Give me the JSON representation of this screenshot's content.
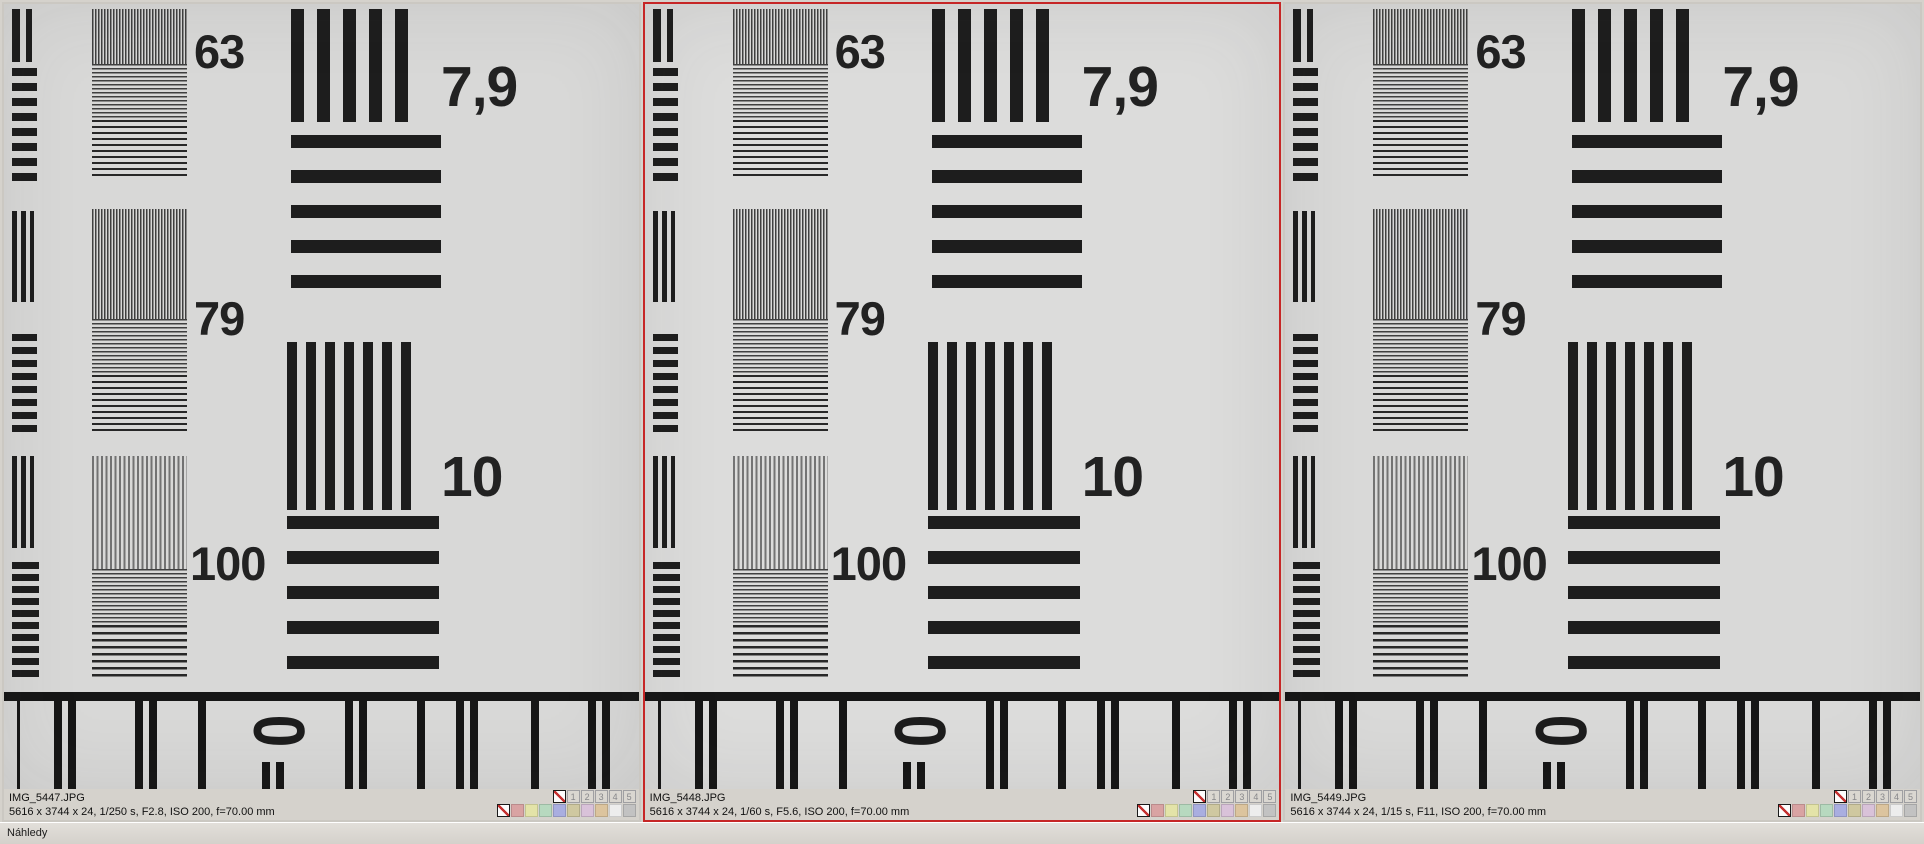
{
  "status_bar": {
    "text": "Náhledy"
  },
  "panels": [
    {
      "filename": "IMG_5447.JPG",
      "details": "5616 x 3744 x 24, 1/250 s, F2.8, ISO 200, f=70.00 mm",
      "selected": false
    },
    {
      "filename": "IMG_5448.JPG",
      "details": "5616 x 3744 x 24, 1/60 s, F5.6, ISO 200, f=70.00 mm",
      "selected": true
    },
    {
      "filename": "IMG_5449.JPG",
      "details": "5616 x 3744 x 24, 1/15 s, F11, ISO 200, f=70.00 mm",
      "selected": false
    }
  ],
  "rating": {
    "stars": [
      "1",
      "2",
      "3",
      "4",
      "5"
    ],
    "label_colors": [
      "#d9a3a3",
      "#e3e3a8",
      "#b7d9bf",
      "#a9aee0",
      "#cfc8a0",
      "#d9c2d9",
      "#dcc49e",
      "#ededed",
      "#c2c2c2"
    ]
  },
  "chart": {
    "labels": {
      "f63": "63",
      "f79": "79",
      "f100": "100",
      "b79": "7,9",
      "b10": "10",
      "zero": "0"
    }
  },
  "colors": {
    "selection_border": "#c62626",
    "chrome": "#d5d2cc",
    "photo_background": "#d8d8d7",
    "ink": "#1d1d1d"
  }
}
